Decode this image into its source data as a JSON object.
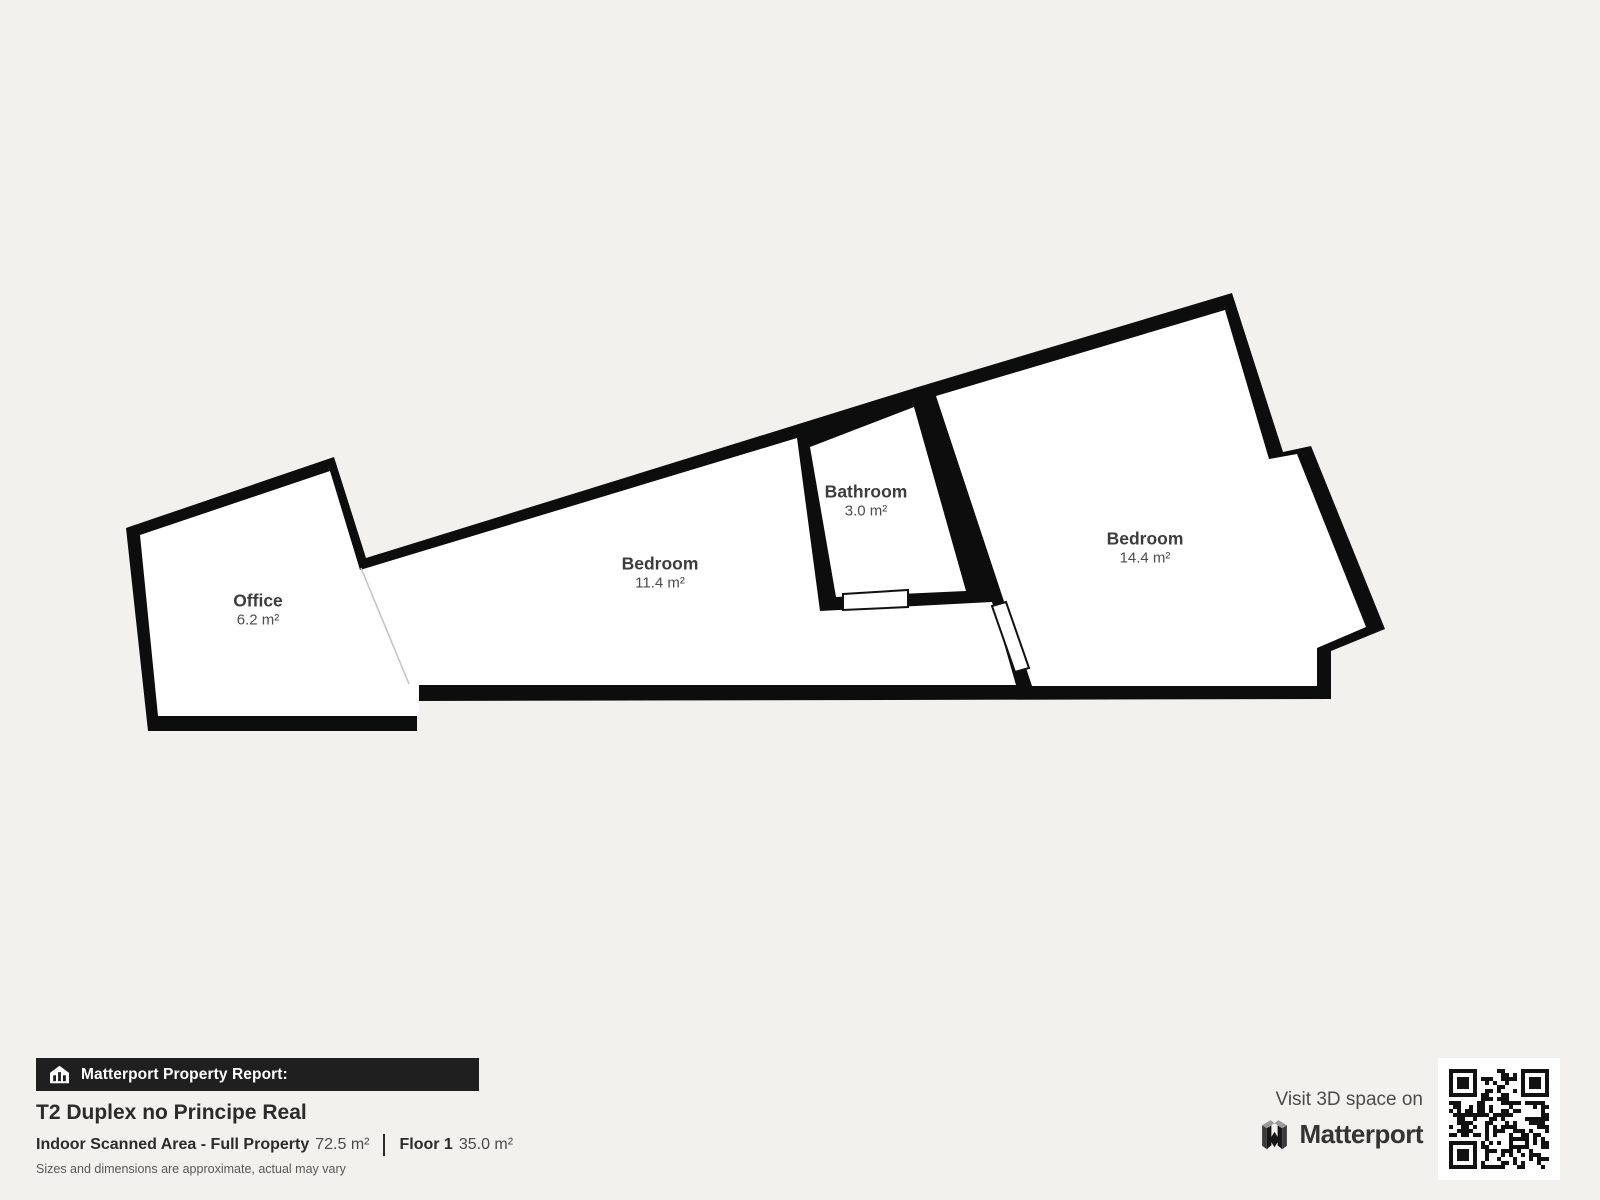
{
  "colors": {
    "background": "#f2f1ee",
    "wall": "#0d0d0d",
    "room_fill": "#ffffff",
    "report_bar_bg": "#1f1f1f",
    "title_text": "#2b2b2b"
  },
  "plan": {
    "rooms": [
      {
        "name": "Office",
        "area": "6.2 m²"
      },
      {
        "name": "Bedroom",
        "area": "11.4 m²"
      },
      {
        "name": "Bathroom",
        "area": "3.0 m²"
      },
      {
        "name": "Bedroom",
        "area": "14.4 m²"
      }
    ]
  },
  "footer": {
    "report_label": "Matterport Property Report:",
    "title": "T2 Duplex no Principe Real",
    "scan_label": "Indoor Scanned Area - Full Property",
    "scan_value": "72.5 m²",
    "floor_label": "Floor 1",
    "floor_value": "35.0 m²",
    "disclaimer": "Sizes and dimensions are approximate, actual may vary"
  },
  "promo": {
    "visit_text": "Visit 3D space on",
    "brand": "Matterport"
  },
  "icons": {
    "house_report": "house-chart-icon",
    "brand_logo": "matterport-logo-icon",
    "qr": "qr-code"
  }
}
